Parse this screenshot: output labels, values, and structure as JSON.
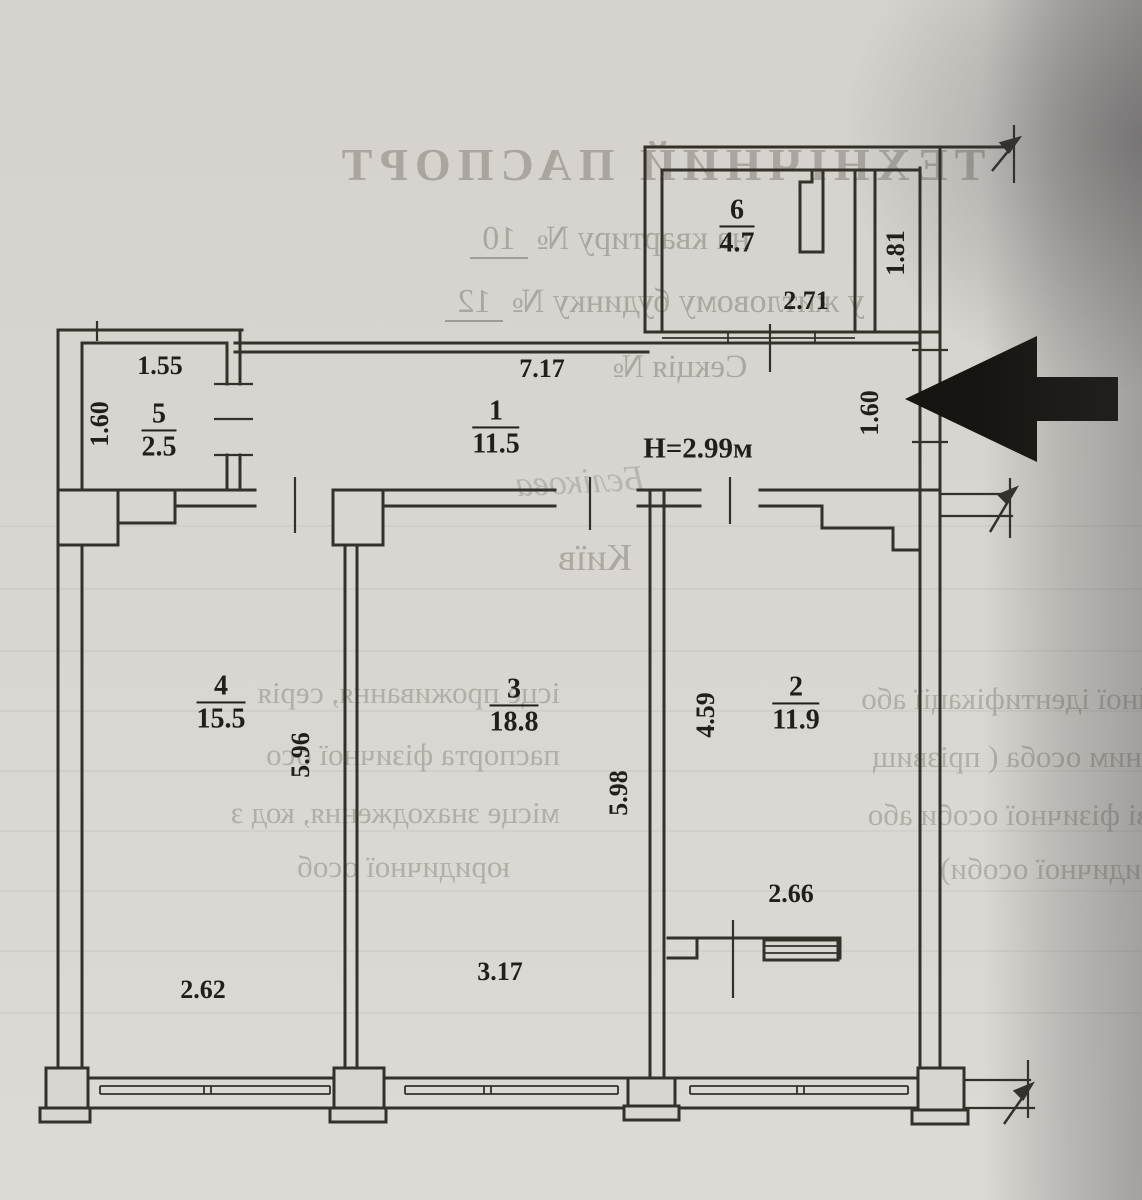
{
  "page": {
    "bleed": {
      "title": "ТЕХНІЧНИЙ ПАСПОРТ",
      "apartment_prefix": "на квартиру № ",
      "apartment_number": "10",
      "building_prefix": "у житловому будинку № ",
      "building_number": "12",
      "section_line": "Секція №",
      "signature": "Бєлікова",
      "city": "Київ",
      "right_paragraph": [
        "ційної ідентифікації або",
        "на ним особа ( прізвищ",
        "кові фізичної особи або",
        "юридичної особи)"
      ],
      "left_paragraph": [
        "ісце проживання, серія",
        "паспорта фізичної осо",
        "місце знаходження, код з",
        "юридичної особ"
      ]
    },
    "plan": {
      "height_note": "H=2.99м",
      "rooms": [
        {
          "number": "6",
          "area": "4.7"
        },
        {
          "number": "5",
          "area": "2.5"
        },
        {
          "number": "1",
          "area": "11.5"
        },
        {
          "number": "4",
          "area": "15.5"
        },
        {
          "number": "3",
          "area": "18.8"
        },
        {
          "number": "2",
          "area": "11.9"
        }
      ],
      "dimensions": {
        "room6_width": "2.71",
        "room6_depth": "1.81",
        "room5_width": "1.55",
        "room5_depth": "1.60",
        "corridor_width": "7.17",
        "balcony_opening": "1.60",
        "room4_depth": "5.96",
        "room4_width": "2.62",
        "room3_depth": "5.98",
        "room3_width": "3.17",
        "room2_depth": "4.59",
        "room2_width": "2.66"
      }
    }
  }
}
